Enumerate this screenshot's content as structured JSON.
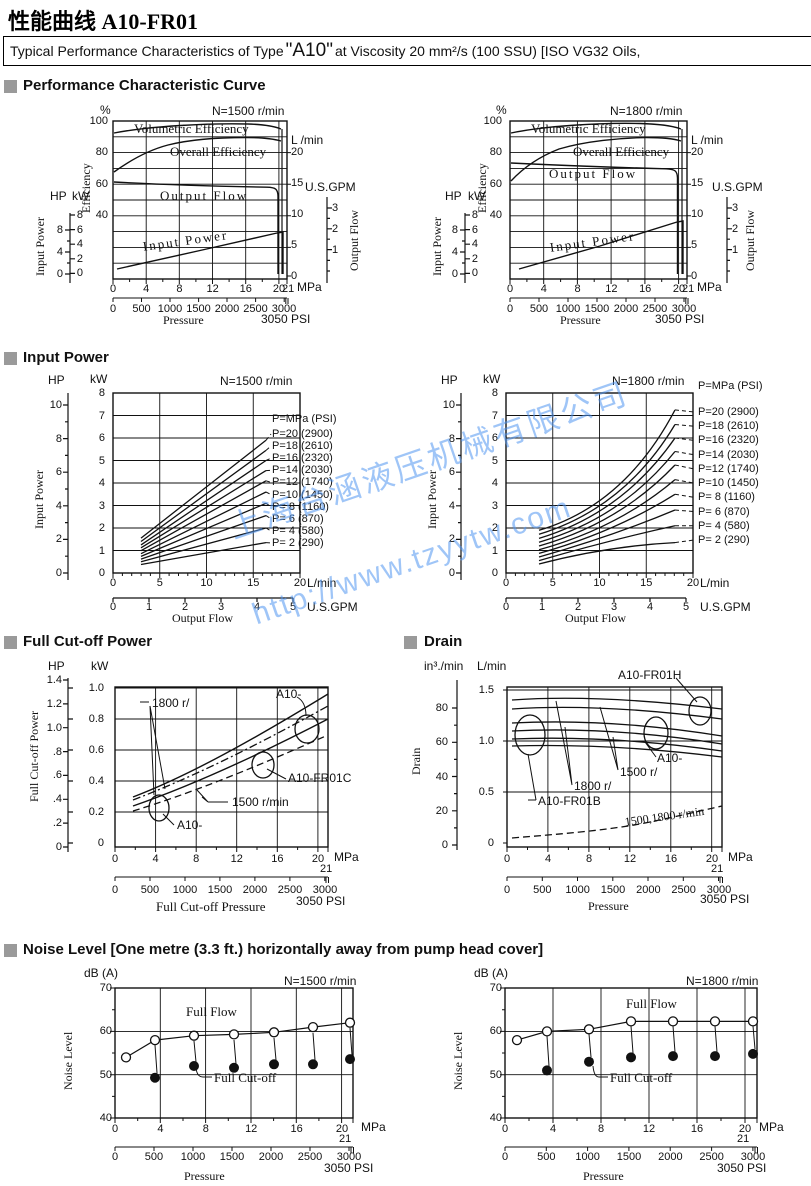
{
  "page": {
    "title": "性能曲线 A10-FR01",
    "box": {
      "prefix": "Typical Performance Characteristics of Type ",
      "type": "\"A10\"",
      "suffix": " at Viscosity 20 mm²/s (100 SSU) [ISO VG32 Oils,"
    }
  },
  "watermark": {
    "company": "上海台涵液压机械有限公司",
    "url": "http://www.tzyytw.com"
  },
  "sections": {
    "perf": "Performance Characteristic Curve",
    "input": "Input Power",
    "cutoff": "Full Cut-off Power",
    "drain": "Drain",
    "noise": "Noise Level [One metre (3.3 ft.) horizontally away from pump head cover]"
  },
  "units": {
    "hp": "HP",
    "kw": "kW",
    "pct": "%",
    "lmin": "L /min",
    "lmin2": "L/min",
    "gpm": "U.S.GPM",
    "mpa": "MPa",
    "n21": "21",
    "psi3050": "3050  PSI",
    "dba": "dB (A)",
    "in3": "in³./min"
  },
  "axis_titles": {
    "efficiency": "Efficiency",
    "input_power": "Input Power",
    "output_flow": "Output Flow",
    "pressure": "Pressure",
    "fc_power": "Full Cut-off  Power",
    "fc_pressure": "Full Cut-off Pressure",
    "drain": "Drain",
    "noise": "Noise Level"
  },
  "speed": {
    "n1500": "N=1500 r/min",
    "n1800": "N=1800 r/min"
  },
  "curve_labels": {
    "vol": "Volumetric Efficiency",
    "overall": "Overall Efficiency",
    "flow": "Output Flow",
    "input": "Input Power",
    "full_flow": "Full Flow",
    "full_cutoff": "Full Cut-off"
  },
  "ticks": {
    "mpa": [
      "0",
      "4",
      "8",
      "12",
      "16",
      "20"
    ],
    "psi": [
      "0",
      "500",
      "1000",
      "1500",
      "2000",
      "2500",
      "3000"
    ],
    "eff": [
      "100",
      "80",
      "60",
      "40"
    ],
    "perf_kw": [
      "8",
      "6",
      "4",
      "2",
      "0"
    ],
    "perf_hp": [
      "8",
      "4",
      "0"
    ],
    "perf_lmin": [
      "20",
      "15",
      "10",
      "5",
      "0"
    ],
    "perf_gpm": [
      "3",
      "2",
      "1"
    ],
    "ip_kw": [
      "8",
      "7",
      "6",
      "5",
      "4",
      "3",
      "2",
      "1",
      "0"
    ],
    "ip_hp": [
      "10",
      "8",
      "6",
      "4",
      "2",
      "0"
    ],
    "ip_lmin": [
      "0",
      "5",
      "10",
      "15",
      "20"
    ],
    "ip_gpm": [
      "0",
      "1",
      "2",
      "3",
      "4",
      "5"
    ],
    "fc_hp": [
      "1.4",
      "1.2",
      "1.0",
      ".8",
      ".6",
      ".4",
      ".2",
      "0"
    ],
    "fc_kw": [
      "1.0",
      "0.8",
      "0.6",
      "0.4",
      "0.2",
      "0"
    ],
    "drain_in3": [
      "80",
      "60",
      "40",
      "20",
      "0"
    ],
    "drain_lmin": [
      "1.5",
      "1.0",
      "0.5",
      "0"
    ],
    "db": [
      "70",
      "60",
      "50",
      "40"
    ]
  },
  "legend": {
    "header": "P=MPa (PSI)",
    "rows": [
      "P=20 (2900)",
      "P=18 (2610)",
      "P=16 (2320)",
      "P=14 (2030)",
      "P=12 (1740)",
      "P=10 (1450)",
      "P= 8 (1160)",
      "P= 6  (870)",
      "P= 4  (580)",
      "P= 2  (290)"
    ]
  },
  "ann": {
    "fc_1800": "1800 r/",
    "fc_a10_top": "A10-",
    "fc_fr01c": "A10-FR01C",
    "fc_1500": "1500 r/min",
    "fc_a10_bot": "A10-",
    "dr_fr01h": "A10-FR01H",
    "dr_a10": "A10-",
    "dr_1500": "1500 r/",
    "dr_1800": "1800 r/",
    "dr_fr01b": "A10-FR01B",
    "dr_both": "1500,1800 r/min"
  },
  "chart_data": [
    {
      "id": "performance_1500",
      "type": "line",
      "title": "N=1500 r/min",
      "xlabel": "Pressure",
      "x_unit": "MPa",
      "x_range": [
        0,
        21
      ],
      "x_psi_range": [
        0,
        3050
      ],
      "y_axes": {
        "efficiency_pct": [
          40,
          100
        ],
        "output_flow_lmin": [
          0,
          20
        ],
        "output_flow_gpm": [
          0,
          3
        ],
        "input_power_kw": [
          0,
          8
        ],
        "input_power_hp": [
          0,
          8
        ]
      },
      "series": [
        {
          "name": "Volumetric Efficiency",
          "unit": "%",
          "x": [
            0.3,
            4,
            8,
            12,
            16,
            20,
            20.6
          ],
          "y": [
            93,
            95,
            96,
            96.5,
            97,
            95.5,
            0
          ]
        },
        {
          "name": "Overall Efficiency",
          "unit": "%",
          "x": [
            0.3,
            2,
            4,
            8,
            12,
            16,
            20
          ],
          "y": [
            68,
            75,
            80,
            86,
            88.5,
            89,
            88
          ]
        },
        {
          "name": "Output Flow",
          "unit": "L/min",
          "x": [
            0,
            10,
            19.8,
            20.4
          ],
          "y": [
            15.2,
            14.8,
            14.3,
            0
          ]
        },
        {
          "name": "Input Power",
          "unit": "kW",
          "x": [
            0.5,
            10,
            20,
            20.5
          ],
          "y": [
            0.6,
            3.2,
            5.8,
            0
          ]
        }
      ]
    },
    {
      "id": "performance_1800",
      "type": "line",
      "title": "N=1800 r/min",
      "xlabel": "Pressure",
      "x_unit": "MPa",
      "x_range": [
        0,
        21
      ],
      "x_psi_range": [
        0,
        3050
      ],
      "series": [
        {
          "name": "Volumetric Efficiency",
          "unit": "%",
          "x": [
            0.3,
            4,
            8,
            12,
            16,
            20,
            20.6
          ],
          "y": [
            93,
            95.5,
            96.5,
            97,
            97.5,
            96,
            0
          ]
        },
        {
          "name": "Overall Efficiency",
          "unit": "%",
          "x": [
            0.3,
            2,
            4,
            8,
            12,
            16,
            20
          ],
          "y": [
            62,
            72,
            80,
            86,
            88.5,
            89,
            88
          ]
        },
        {
          "name": "Output Flow",
          "unit": "L/min",
          "x": [
            0,
            10,
            19.8,
            20.4
          ],
          "y": [
            18.3,
            17.8,
            17.3,
            0
          ]
        },
        {
          "name": "Input Power",
          "unit": "kW",
          "x": [
            1,
            10,
            20,
            20.5
          ],
          "y": [
            0.6,
            3.9,
            7.2,
            0
          ]
        }
      ]
    },
    {
      "id": "input_power_1500",
      "type": "line",
      "title": "N=1500 r/min",
      "xlabel": "Output Flow",
      "x_unit": "L/min",
      "x_range": [
        0,
        20
      ],
      "y_unit": "kW",
      "y_range": [
        0,
        8
      ],
      "series": [
        {
          "name": "P=20 (2900)",
          "x": [
            3,
            16.5
          ],
          "kw": [
            1.55,
            5.9
          ]
        },
        {
          "name": "P=18 (2610)",
          "x": [
            3,
            16.5
          ],
          "kw": [
            1.4,
            5.45
          ]
        },
        {
          "name": "P=16 (2320)",
          "x": [
            3,
            16.5
          ],
          "kw": [
            1.25,
            5.0
          ]
        },
        {
          "name": "P=14 (2030)",
          "x": [
            3,
            16.5
          ],
          "kw": [
            1.12,
            4.55
          ]
        },
        {
          "name": "P=12 (1740)",
          "x": [
            3,
            16.5
          ],
          "kw": [
            0.99,
            4.1
          ]
        },
        {
          "name": "P=10 (1450)",
          "x": [
            3,
            16.5
          ],
          "kw": [
            0.86,
            3.6
          ]
        },
        {
          "name": "P= 8 (1160)",
          "x": [
            3,
            16.5
          ],
          "kw": [
            0.74,
            3.1
          ]
        },
        {
          "name": "P= 6  (870)",
          "x": [
            3,
            16.5
          ],
          "kw": [
            0.62,
            2.55
          ]
        },
        {
          "name": "P= 4  (580)",
          "x": [
            3,
            16.5
          ],
          "kw": [
            0.5,
            2.0
          ]
        },
        {
          "name": "P= 2  (290)",
          "x": [
            3,
            16.5
          ],
          "kw": [
            0.38,
            1.35
          ]
        }
      ]
    },
    {
      "id": "input_power_1800",
      "type": "line",
      "title": "N=1800 r/min",
      "xlabel": "Output Flow",
      "x_unit": "L/min",
      "x_range": [
        0,
        20
      ],
      "y_unit": "kW",
      "y_range": [
        0,
        8
      ],
      "series": [
        {
          "name": "P=20 (2900)",
          "x": [
            3.5,
            19
          ],
          "kw": [
            1.9,
            7.25
          ]
        },
        {
          "name": "P=18 (2610)",
          "x": [
            3.5,
            19
          ],
          "kw": [
            1.72,
            6.6
          ]
        },
        {
          "name": "P=16 (2320)",
          "x": [
            3.5,
            19
          ],
          "kw": [
            1.54,
            6.0
          ]
        },
        {
          "name": "P=14 (2030)",
          "x": [
            3.5,
            19
          ],
          "kw": [
            1.37,
            5.4
          ]
        },
        {
          "name": "P=12 (1740)",
          "x": [
            3.5,
            19
          ],
          "kw": [
            1.2,
            4.8
          ]
        },
        {
          "name": "P=10 (1450)",
          "x": [
            3.5,
            19
          ],
          "kw": [
            1.03,
            4.15
          ]
        },
        {
          "name": "P= 8 (1160)",
          "x": [
            3.5,
            19
          ],
          "kw": [
            0.87,
            3.5
          ]
        },
        {
          "name": "P= 6  (870)",
          "x": [
            3.5,
            19
          ],
          "kw": [
            0.71,
            2.8
          ]
        },
        {
          "name": "P= 4  (580)",
          "x": [
            3.5,
            19
          ],
          "kw": [
            0.55,
            2.1
          ]
        },
        {
          "name": "P= 2  (290)",
          "x": [
            3.5,
            19
          ],
          "kw": [
            0.4,
            1.35
          ]
        }
      ]
    },
    {
      "id": "full_cutoff_power",
      "type": "line",
      "xlabel": "Full Cut-off Pressure",
      "x_unit": "MPa",
      "x_range": [
        0,
        21
      ],
      "y_unit": "kW",
      "y_range": [
        0,
        1.0
      ],
      "x_mpa": [
        2,
        8,
        14,
        21
      ],
      "series": [
        {
          "name": "A10- (1800 r/min)",
          "style": "solid",
          "kw": [
            0.3,
            0.48,
            0.7,
            0.97
          ]
        },
        {
          "name": "A10-FR01C (1800 r/min)",
          "style": "dash-dot",
          "kw": [
            0.27,
            0.43,
            0.63,
            0.88
          ]
        },
        {
          "name": "A10- (1500 r/min)",
          "style": "solid",
          "kw": [
            0.24,
            0.38,
            0.56,
            0.8
          ]
        },
        {
          "name": "A10-FR01C (1500 r/min)",
          "style": "dashed",
          "kw": [
            0.2,
            0.33,
            0.48,
            0.7
          ]
        }
      ]
    },
    {
      "id": "drain",
      "type": "line",
      "xlabel": "Pressure",
      "x_unit": "MPa",
      "x_range": [
        0,
        21
      ],
      "y_unit": "L/min",
      "y_range": [
        0,
        1.5
      ],
      "x_mpa": [
        0.5,
        10,
        21
      ],
      "series": [
        {
          "name": "A10-FR01H (1800 r/min)",
          "lmin": [
            1.4,
            1.44,
            1.31
          ]
        },
        {
          "name": "A10-FR01H (1500 r/min)",
          "lmin": [
            1.31,
            1.34,
            1.22
          ]
        },
        {
          "name": "A10- (1800 r/min)",
          "lmin": [
            1.18,
            1.2,
            1.05
          ]
        },
        {
          "name": "A10- (1500 r/min)",
          "lmin": [
            1.1,
            1.12,
            0.97
          ]
        },
        {
          "name": "A10-FR01B (1800 r/min)",
          "lmin": [
            1.02,
            1.03,
            0.9
          ]
        },
        {
          "name": "A10-FR01B (1500 r/min)",
          "lmin": [
            0.95,
            0.96,
            0.85
          ]
        },
        {
          "name": "1500,1800 r/min",
          "style": "dashed",
          "lmin": [
            0.05,
            0.14,
            0.36
          ]
        }
      ]
    },
    {
      "id": "noise_1500",
      "type": "scatter-line",
      "title": "N=1500 r/min",
      "xlabel": "Pressure",
      "x_unit": "MPa",
      "x_range": [
        0,
        21
      ],
      "y_unit": "dB (A)",
      "y_range": [
        40,
        70
      ],
      "series": [
        {
          "name": "Full Flow",
          "marker": "open-circle",
          "mpa": [
            1,
            3.5,
            7,
            10.5,
            14,
            17.5,
            21
          ],
          "db": [
            54,
            58,
            59,
            59.3,
            59.8,
            61,
            62
          ]
        },
        {
          "name": "Full Cut-off",
          "marker": "filled-circle",
          "mpa": [
            3.5,
            7,
            10.5,
            14,
            17.5,
            21
          ],
          "db": [
            49.3,
            52,
            51.6,
            52.4,
            52.4,
            53.6
          ]
        }
      ]
    },
    {
      "id": "noise_1800",
      "type": "scatter-line",
      "title": "N=1800 r/min",
      "xlabel": "Pressure",
      "x_unit": "MPa",
      "x_range": [
        0,
        21
      ],
      "y_unit": "dB (A)",
      "y_range": [
        40,
        70
      ],
      "series": [
        {
          "name": "Full Flow",
          "marker": "open-circle",
          "mpa": [
            1,
            3.5,
            7,
            10.5,
            14,
            17.5,
            21
          ],
          "db": [
            58,
            60,
            60.5,
            62.3,
            62.3,
            62.3,
            62.3
          ]
        },
        {
          "name": "Full Cut-off",
          "marker": "filled-circle",
          "mpa": [
            3.5,
            7,
            10.5,
            14,
            17.5,
            21
          ],
          "db": [
            51,
            53,
            54,
            54.3,
            54.3,
            54.8
          ]
        }
      ]
    }
  ]
}
